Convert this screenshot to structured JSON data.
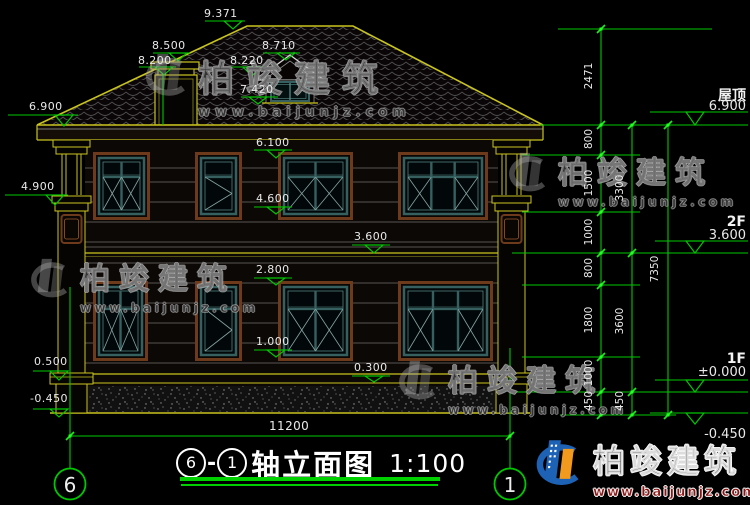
{
  "watermark": {
    "brand": "柏竣建筑",
    "url": "www.baijunjz.com"
  },
  "title": {
    "axis_from": "6",
    "separator": "-",
    "axis_to": "1",
    "name": "轴立面图",
    "scale": "1:100"
  },
  "axis_bubbles": {
    "left": "6",
    "right": "1"
  },
  "elevations": {
    "ridge": "9.371",
    "chimney_top": "8.500",
    "chimney_base": "8.200",
    "dormer_peak": "8.710",
    "dormer_eave": "8.220",
    "dormer_sill": "7.420",
    "eave": "6.900",
    "capital": "4.900",
    "window2f_top": "6.100",
    "window2f_sill": "4.600",
    "floor2": "3.600",
    "window1f_top": "2.800",
    "window1f_sill": "1.000",
    "base_top": "0.300",
    "plinth": "0.500",
    "ground": "-0.450"
  },
  "dimensions": {
    "total_width": "11200",
    "right_inner": [
      "2471",
      "800",
      "1500",
      "1000",
      "800",
      "1800",
      "1000",
      "450"
    ],
    "right_middle": [
      "3300",
      "3600",
      "450"
    ],
    "right_outer": [
      "7350"
    ]
  },
  "right_levels": {
    "roof_label": "屋顶",
    "roof_value": "6.900",
    "f2_label": "2F",
    "f2_value": "3.600",
    "f1_label": "1F",
    "f1_value": "±0.000",
    "ground_value": "-0.450"
  },
  "colors": {
    "dimension_green": "#00c800",
    "drawing_yellow": "#c9c41f",
    "window_teal": "#35605f",
    "frame_brown": "#6e3a1c",
    "logo_blue": "#1e62b5",
    "logo_orange": "#f29a1d"
  }
}
